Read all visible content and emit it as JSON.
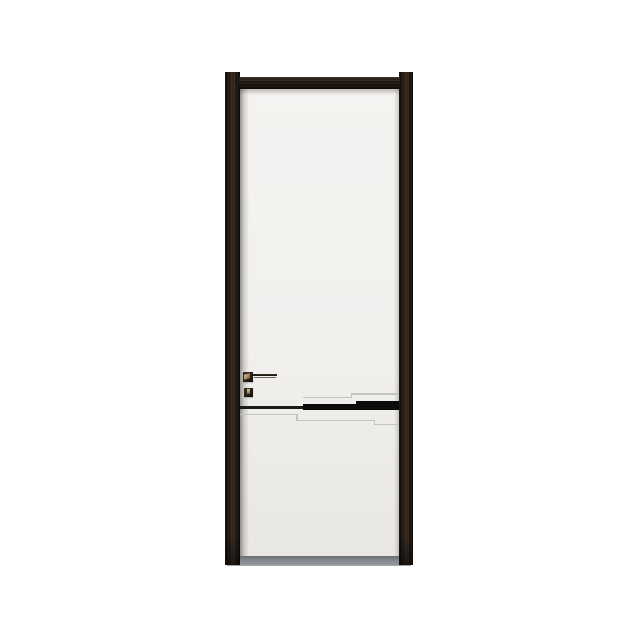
{
  "scene": {
    "type": "product-photo",
    "subject": "modern minimalist interior door, white leaf in dark wood frame",
    "background_color": "#ffffff"
  },
  "door": {
    "frame": {
      "description": "dark espresso wood frame with stiles rising slightly above the top rail",
      "color": "#1e1712",
      "highlight": "#372a1f",
      "shadow": "#0f0b08"
    },
    "leaf": {
      "description": "flat white door leaf",
      "color": "#f1f0ed",
      "color_bottom": "#e9e7e4",
      "color_top": "#f4f3f1"
    },
    "handle": {
      "type": "square-rose lever handle with keyhole escutcheon",
      "finish_dark": "#251e18",
      "finish_brass": "#a88b5e",
      "lever_underside": "#6b6560"
    },
    "inlay": {
      "description": "stepped black inlay stripe widening toward the right stile, with light embossed groove echo lines above and below",
      "color": "#0c0c0c",
      "thin_color": "#1a1a1a",
      "groove_color": "#c6c4c0"
    },
    "floor_shadow": {
      "description": "gray shadow strip under the door",
      "color": "#7f858a",
      "edge_color": "#646a6e"
    }
  }
}
